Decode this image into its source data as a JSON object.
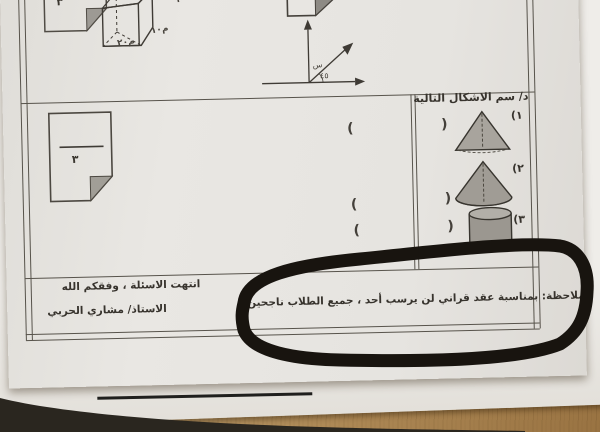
{
  "photo": {
    "desk_color": "#bd9d6c",
    "marker_color": "#18140f",
    "paper_color": "#e6e4e0"
  },
  "paper": {
    "top_section": {
      "cut_note_value": "٣",
      "cuboid": {
        "labels": {
          "top": "٢٠",
          "right": "م١٠",
          "bottom": "م٢٠"
        }
      },
      "axes": {
        "axis_label": "س",
        "angle_label": "٤٥"
      }
    },
    "left_note": {
      "value": "٣"
    },
    "question": {
      "header": "د/ سم الاشكال التالية",
      "answer_open": "(",
      "answer_close": ")",
      "items": [
        {
          "num": "١)",
          "shape_name": "pyramid-cone-drawing"
        },
        {
          "num": "٢)",
          "shape_name": "cone-drawing"
        },
        {
          "num": "٣)",
          "shape_name": "cylinder-drawing"
        }
      ]
    },
    "footer": {
      "closing_line": "انتهت الاسئلة ، وفقكم الله",
      "teacher_line": "الاستاذ/ مشاري الحربي",
      "note_line": "ملاحظة: بمناسبة عقد قراني لن يرسب أحد ، جميع الطلاب ناجحين"
    }
  }
}
